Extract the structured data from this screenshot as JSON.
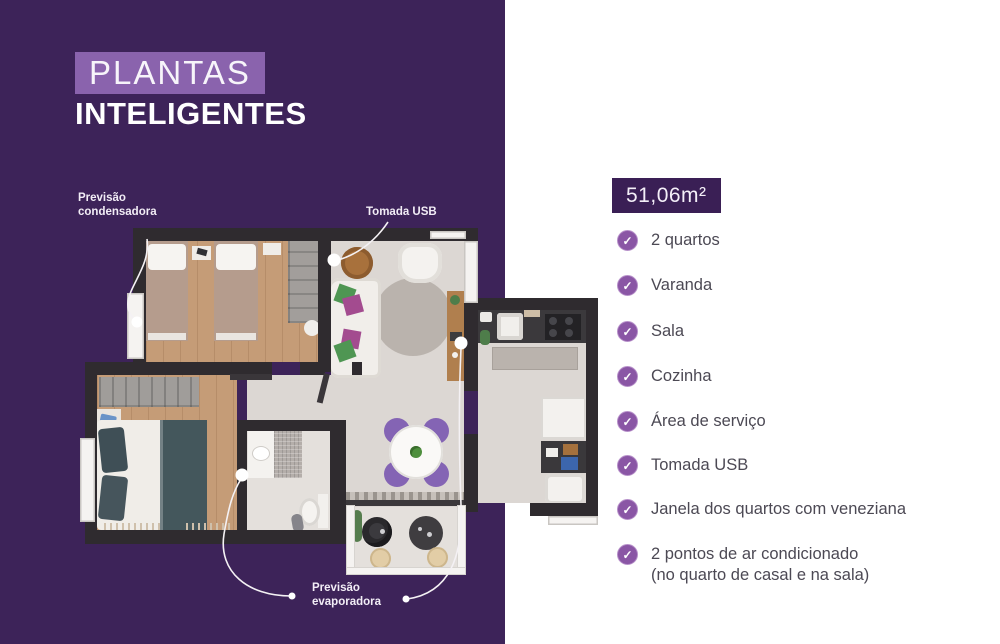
{
  "page": {
    "panel_color": "#3d2359",
    "background_color": "#ffffff",
    "accent_purple": "#8a63ad",
    "check_purple": "#8a56a5"
  },
  "title": {
    "line1": "PLANTAS",
    "line2": "INTELIGENTES"
  },
  "area_badge": {
    "value": "51,06m²"
  },
  "icons": {
    "check": "✓"
  },
  "features": {
    "items": [
      {
        "label": "2 quartos"
      },
      {
        "label": "Varanda"
      },
      {
        "label": "Sala"
      },
      {
        "label": "Cozinha"
      },
      {
        "label": "Área de serviço"
      },
      {
        "label": "Tomada USB"
      },
      {
        "label": "Janela dos quartos com veneziana"
      },
      {
        "label": "2 pontos de ar condicionado",
        "sublabel": "(no quarto de casal e na sala)"
      }
    ]
  },
  "floor_plan": {
    "annotations": {
      "condensadora": {
        "line1": "Previsão",
        "line2": "condensadora"
      },
      "tomada_usb": {
        "label": "Tomada USB"
      },
      "evaporadora": {
        "line1": "Previsão",
        "line2": "evaporadora"
      }
    }
  }
}
